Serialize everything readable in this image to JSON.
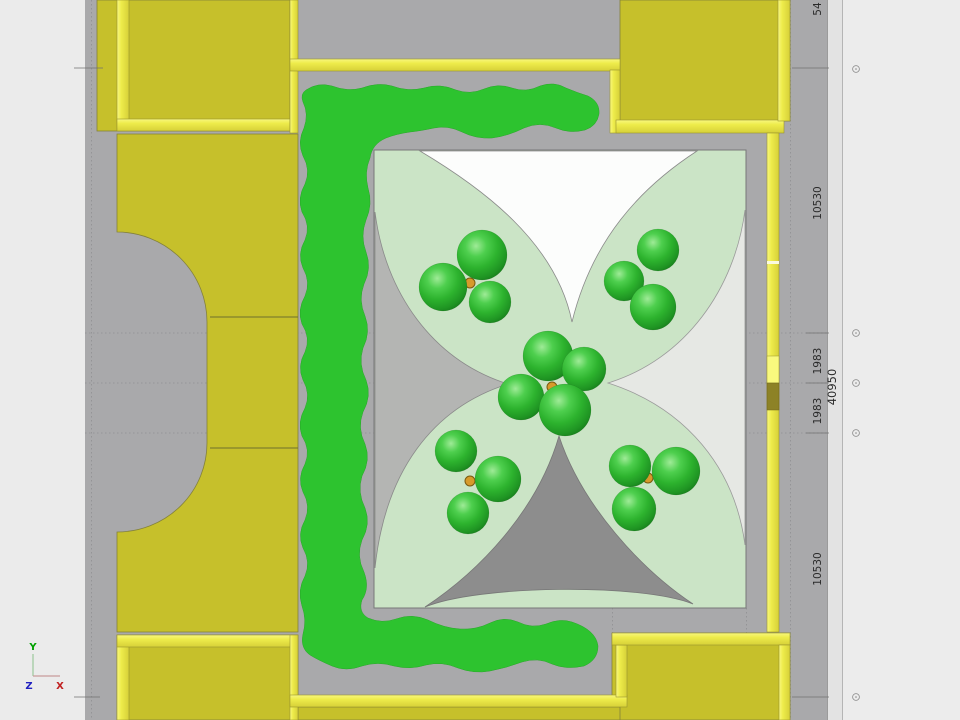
{
  "viewport": {
    "type": "cad-plan-view",
    "description": "Top view site plan with buildings, hedge, courtyard canopy and trees"
  },
  "dimension_strip": {
    "labels": [
      {
        "text": "54"
      },
      {
        "text": "10530"
      },
      {
        "text": "1983"
      },
      {
        "text": "1983"
      },
      {
        "text": "10530"
      }
    ],
    "overall_label": {
      "text": "40950"
    }
  },
  "axis_triad": {
    "x_label": "X",
    "y_label": "Y",
    "z_label": "Z"
  },
  "colors": {
    "ground_gray": "#a9a9ab",
    "margin_gray": "#ebebeb",
    "building_yellow": "#c6c02b",
    "wall_yellow": "#eeec4b",
    "wall_dark_olive": "#8d8226",
    "hedge_green": "#2dc32f",
    "courtyard_green": "#cbe4c6",
    "canopy_white": "#fcfdfc",
    "canopy_gray_left": "#b4b5b3",
    "canopy_gray_right": "#e6e8e4",
    "canopy_gray_bottom": "#8d8d8d",
    "tree_green": "#2db32e",
    "trunk_orange": "#d79a2b",
    "axis_x_red": "#c02020",
    "axis_y_green": "#00a000",
    "axis_z_blue": "#2020c0"
  },
  "trees": {
    "clusters": [
      {
        "name": "top-left",
        "trunk": [
          470,
          283
        ],
        "spheres": [
          [
            443,
            287,
            24
          ],
          [
            482,
            255,
            25
          ],
          [
            490,
            302,
            21
          ]
        ]
      },
      {
        "name": "top-right",
        "trunk": [
          648,
          293
        ],
        "spheres": [
          [
            658,
            250,
            21
          ],
          [
            624,
            281,
            20
          ],
          [
            653,
            307,
            23
          ]
        ]
      },
      {
        "name": "center",
        "trunk": [
          552,
          387
        ],
        "spheres": [
          [
            521,
            397,
            23
          ],
          [
            548,
            356,
            25
          ],
          [
            584,
            369,
            22
          ],
          [
            565,
            410,
            26
          ]
        ]
      },
      {
        "name": "bottom-left",
        "trunk": [
          470,
          481
        ],
        "spheres": [
          [
            456,
            451,
            21
          ],
          [
            498,
            479,
            23
          ],
          [
            468,
            513,
            21
          ]
        ]
      },
      {
        "name": "bottom-right",
        "trunk": [
          648,
          478
        ],
        "spheres": [
          [
            676,
            471,
            24
          ],
          [
            630,
            466,
            21
          ],
          [
            634,
            509,
            22
          ]
        ]
      }
    ]
  }
}
